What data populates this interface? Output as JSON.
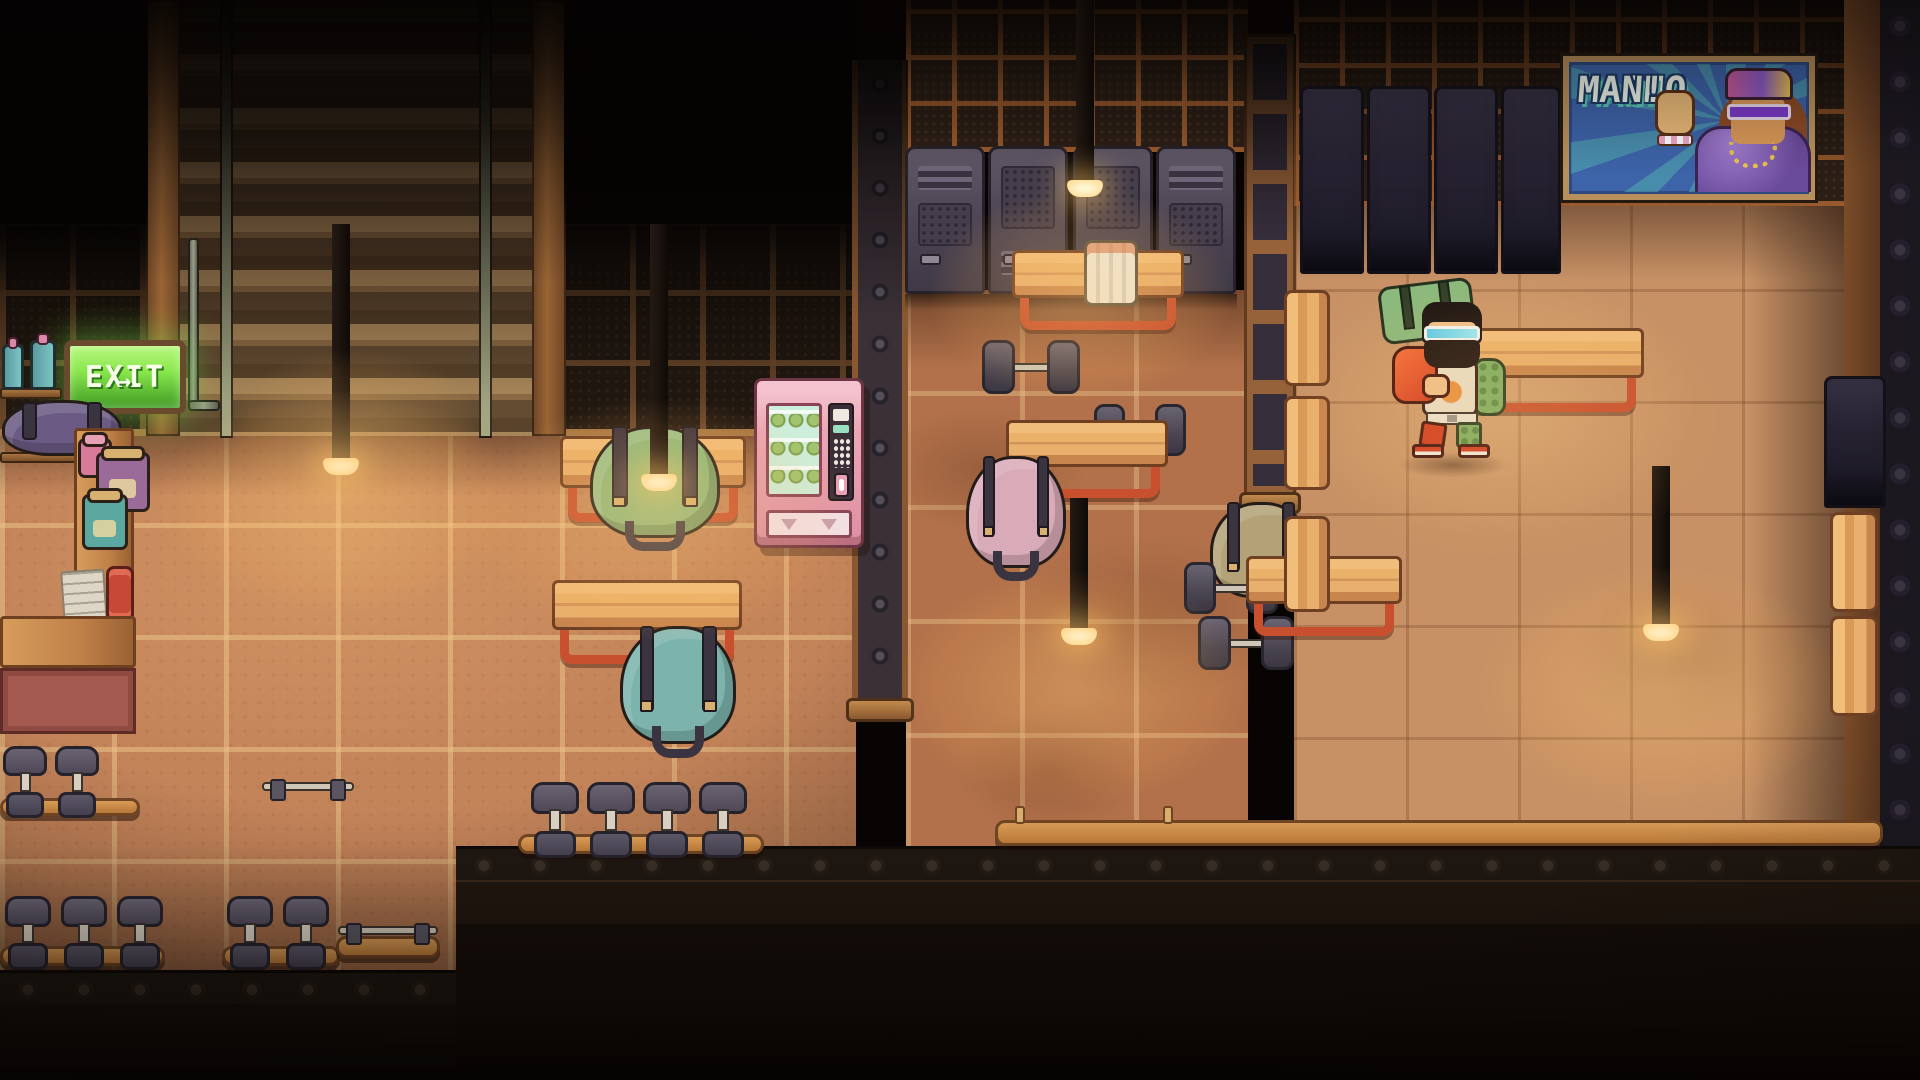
{
  "scene": {
    "name": "pixel-gym-interior",
    "description": "Top-down pixel-art gym scene with lockers, wooden benches, dumbbells, gym bags, a vending machine, hanging lamps, a neon exit sign and a bodybuilder poster"
  },
  "exit_sign": {
    "label": "EXIT",
    "arrow": "→"
  },
  "poster": {
    "line1": "MACHO",
    "line2": "MAN!"
  },
  "objects": {
    "lockers_middle_count": 4,
    "lockers_right_count": 4,
    "benches_count": 11,
    "gym_bag_colors": [
      "green",
      "teal",
      "pink",
      "olive",
      "purple"
    ],
    "floor_dumbbells_count": 4,
    "racked_dumbbells_count": 12,
    "hanging_lamps_count": 5,
    "towels_count": 2,
    "supplement_jars_count": 3,
    "vending_machine_count": 1
  },
  "colors": {
    "exit-green": "#8ae84e",
    "exit-green-dark": "#3f9a22",
    "poster-blue": "#3d63a8",
    "poster-teal": "#57c4b2",
    "vending-pink": "#eba6b4",
    "mint": "#cdeeda",
    "leg-red": "#c8502e",
    "wood-light": "#eab269",
    "wood-dark": "#6e3f22",
    "bag-green": "#8cb97c",
    "bag-teal": "#7cb4ad",
    "bag-pink": "#d9abb8",
    "bag-olive": "#b3a277",
    "bag-purple": "#6b5b84",
    "locker-gray": "#4b4452",
    "locker-navy": "#262231",
    "floor-left": "#c4845a",
    "floor-mid": "#b2714a",
    "floor-right": "#c79165",
    "lamp-glow": "#ffd687"
  }
}
